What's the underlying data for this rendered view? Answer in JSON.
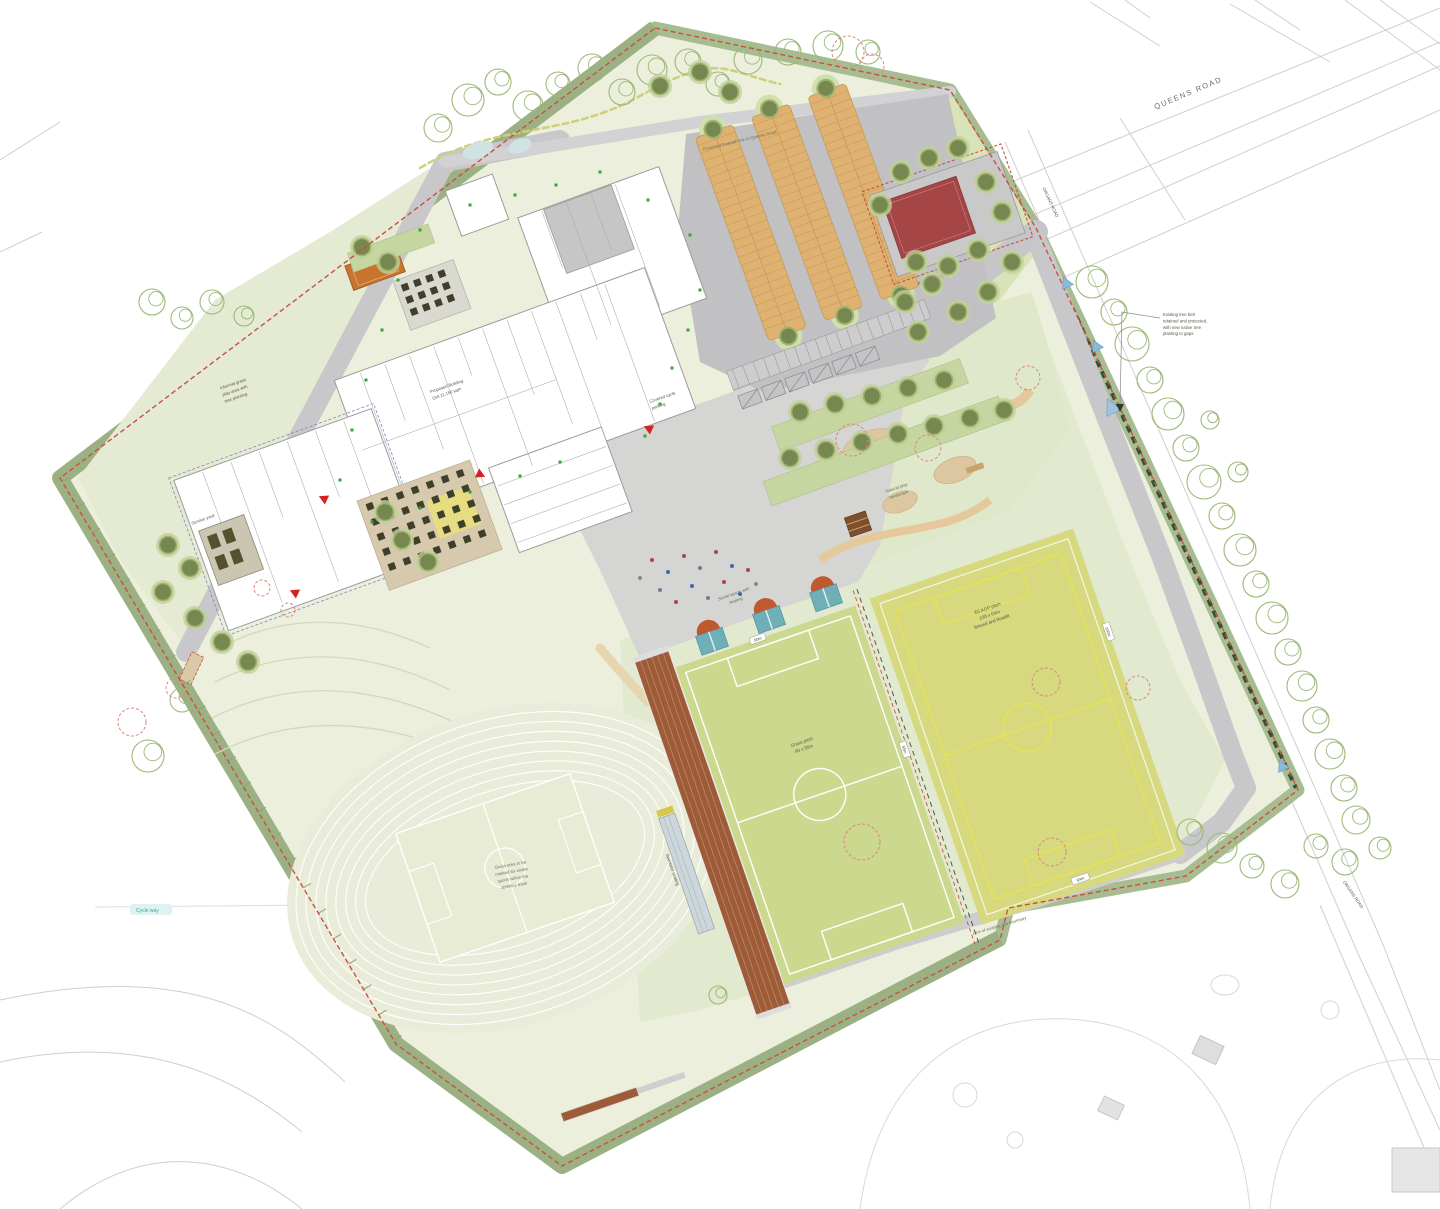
{
  "title": "Proposed school campus masterplan site plan",
  "palette": {
    "site_band_green": "#9cb183",
    "lawn_green": "#ecefdb",
    "pitch_green": "#cbd88e",
    "agp_yellow": "#d6d97e",
    "track_brown": "#9e5b38",
    "muga_red": "#a64545",
    "parking_bay_tan": "#dfb271",
    "boundary_red": "#c94f44",
    "entrance_blue": "#8ab9d9"
  },
  "roads": {
    "queens": "QUEENS ROAD",
    "east": "ORGANS ROAD"
  },
  "buildings": {
    "main_line1": "Proposed Building",
    "main_line2": "GIA 11,150 sqm",
    "service": "Service yard"
  },
  "sports": {
    "west_pitch_1": "Grass pitch",
    "west_pitch_2": "90 x 55m",
    "east_pitch_1": "3G AGP pitch",
    "east_pitch_2": "100 x 64m",
    "east_pitch_3": "fenced and floodlit",
    "muga_1": "Floodlit MUGA",
    "muga_2": "35 x 20m",
    "sprint": "6 lane 100m sprint straight",
    "stand": "Spectator seating",
    "track_note_1": "Grass area to be",
    "track_note_2": "marked for winter",
    "track_note_3": "sports within the",
    "track_note_4": "athletics track",
    "d90": "90m",
    "d55": "55m",
    "d100": "100m",
    "d64": "64m"
  },
  "notes": {
    "tree_belt_1": "Existing tree belt",
    "tree_belt_2": "retained and protected,",
    "tree_belt_3": "with new native tree",
    "tree_belt_4": "planting to gaps",
    "top_path": "Proposed footpath link to Queens Road",
    "informal_1": "Informal grass",
    "informal_2": "play area with",
    "informal_3": "tree planting",
    "boundary": "Line of existing site boundary",
    "cycle_way": "Cycle way",
    "social_1": "Social space with",
    "social_2": "seating",
    "natural_1": "Natural play",
    "natural_2": "landscape",
    "cycle_parking_1": "Covered cycle",
    "cycle_parking_2": "parking"
  }
}
